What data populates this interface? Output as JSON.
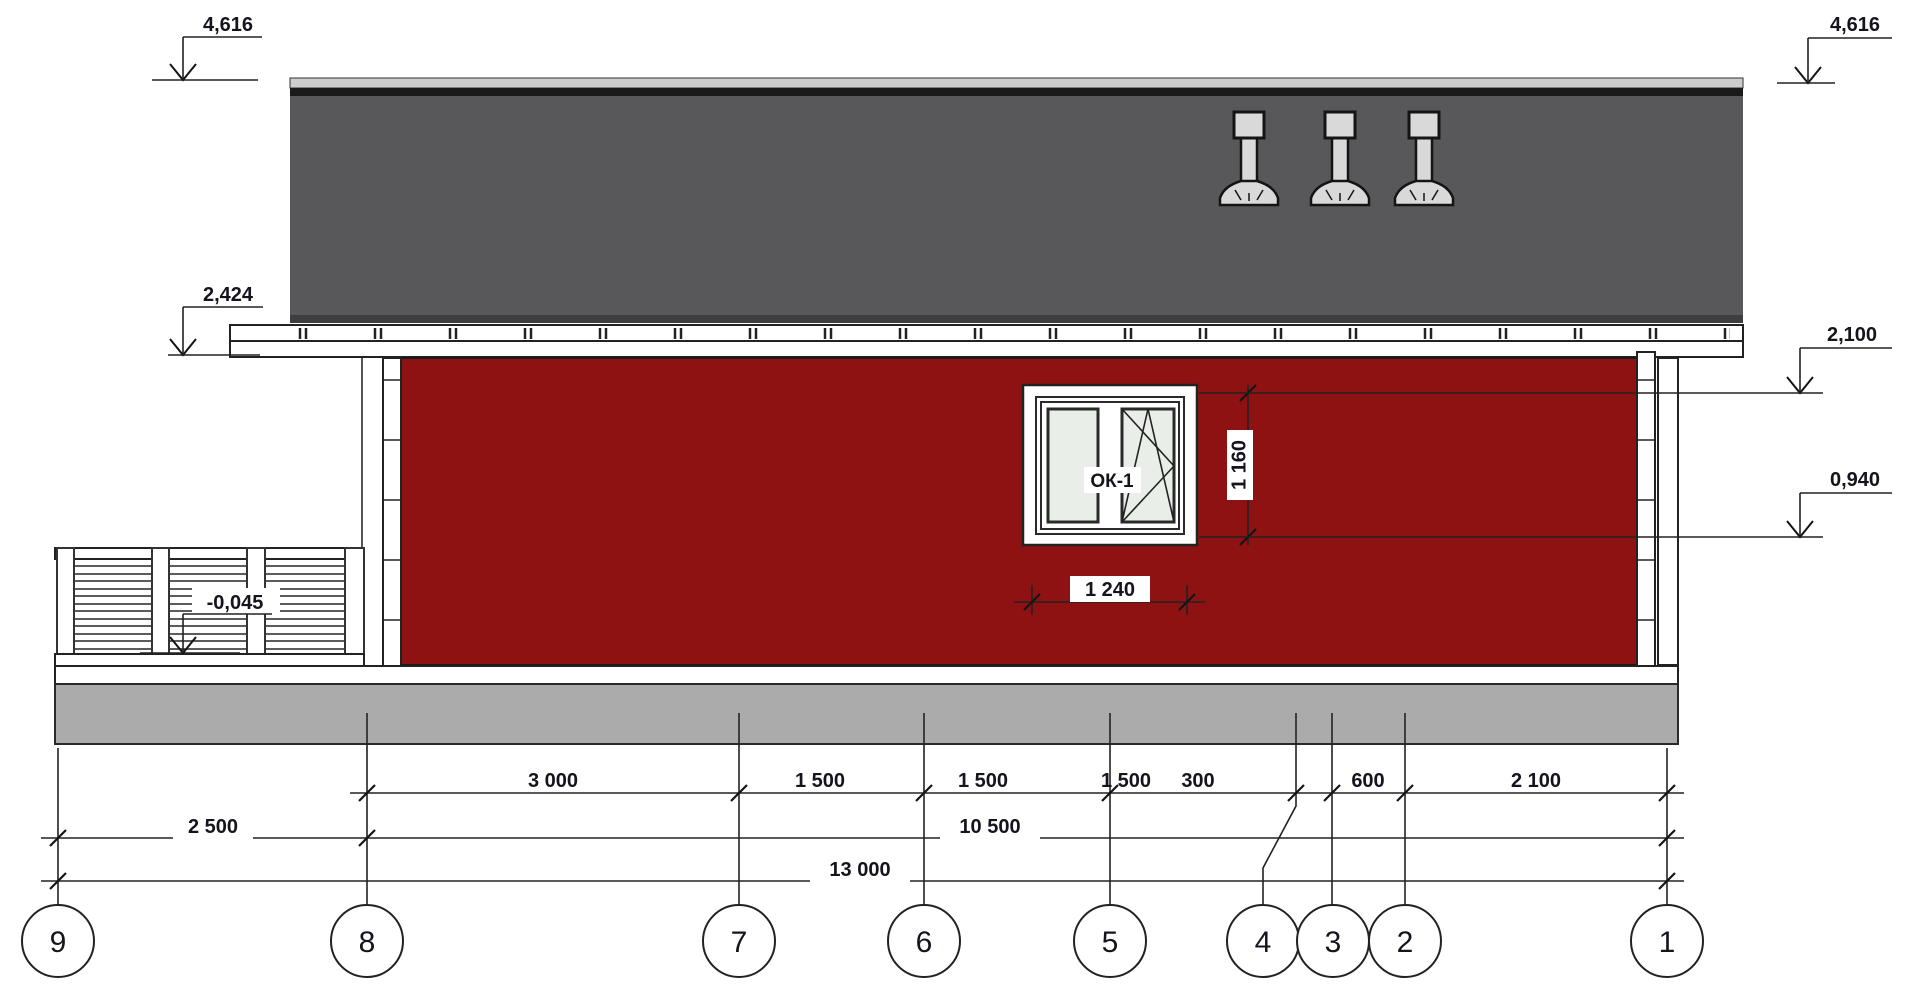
{
  "title": "House elevation drawing, axes 9-1",
  "levels": {
    "roof_left": "4,616",
    "roof_right": "4,616",
    "eave_left": "2,424",
    "window_head": "2,100",
    "window_sill": "0,940",
    "porch_floor": "-0,045"
  },
  "window": {
    "tag": "ОК-1",
    "height_mm": "1 160",
    "width_mm": "1 240"
  },
  "dimensions": {
    "row1": [
      "3 000",
      "1 500",
      "1 500",
      "1 500",
      "300",
      "600",
      "2 100"
    ],
    "row2": [
      "2 500",
      "10 500"
    ],
    "row3": [
      "13 000"
    ]
  },
  "axes": [
    "9",
    "8",
    "7",
    "6",
    "5",
    "4",
    "3",
    "2",
    "1"
  ],
  "colors": {
    "wall": "#8E1212",
    "roof": "#58585B",
    "roof_edge_dark": "#1A1A1A",
    "roof_edge_light": "#CDCDCD",
    "foundation": "#ABABAB",
    "pane": "#E9EFE8",
    "chimney": "#D9D9D9"
  }
}
